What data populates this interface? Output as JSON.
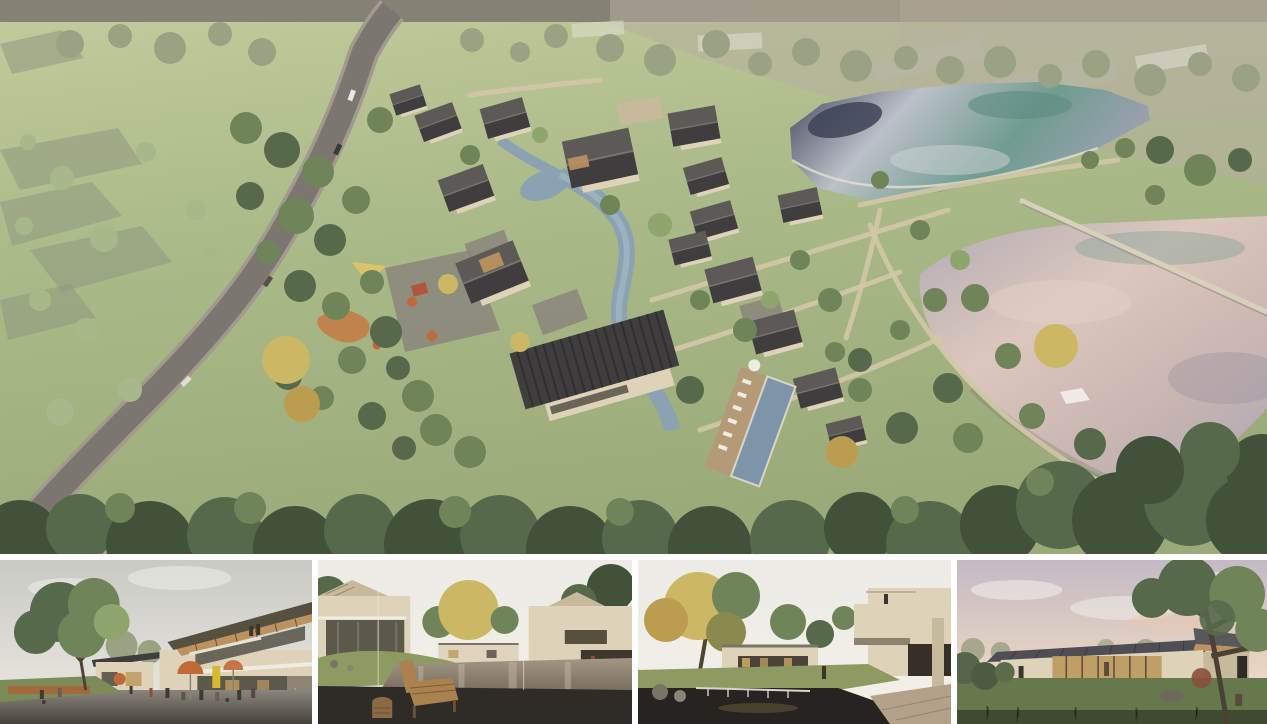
{
  "board": {
    "kind": "architectural rendering presentation board",
    "main_panel": {
      "name": "aerial-site-render",
      "description": "Aerial rendering of a courtyard-house resort village with dark gable roofs along a winding stream, an access road on the left, two large ponds on the right and dense tree canopy in the foreground"
    },
    "thumbnails": [
      {
        "name": "plaza-cafe-view",
        "description": "Street-level plaza with cafe umbrellas and people below a two-storey building with a slanted timber roof"
      },
      {
        "name": "courtyard-pool-view",
        "description": "Reflecting-pool courtyard between beige houses with a wooden lounge chair on a dark deck in the foreground"
      },
      {
        "name": "garden-pond-view",
        "description": "Garden court with a waterfall pond, autumn tree and cantilevered beige guest-room volumes"
      },
      {
        "name": "pavilion-dusk-view",
        "description": "Single-storey glass pavilion with a dark standing-seam roof on a lawn under a pink dusk sky"
      }
    ]
  },
  "palette": {
    "field1": "#b6af9f",
    "field2": "#c3cb9d",
    "field3": "#aaba88",
    "field4": "#9aab79",
    "roadDark": "#7b766f",
    "roadLight": "#a29a8e",
    "pathTan": "#d3c6a7",
    "canopyDark": "#41513a",
    "canopyMid": "#57694b",
    "treeMid": "#6f8458",
    "treeLight": "#8ea56e",
    "treePale": "#a9b88a",
    "treeHazy": "#99a384",
    "gold": "#ccb765",
    "goldDeep": "#bc9c4e",
    "roofDark": "#3f3d3e",
    "roofLight": "#5d5957",
    "roofRidge": "#787570",
    "wall": "#ded3b9",
    "wallShade": "#c6b99c",
    "wood": "#bb9260",
    "streamBlue": "#8ba2b2",
    "streamLight": "#aabfca",
    "poolBlue": "#7e95a9",
    "deckTan": "#b49a76",
    "pondNavy": "#3e4257",
    "pondSilver": "#bcc0c8",
    "pondTeal": "#6f9c90",
    "pondGrayBlue": "#9aa1ae",
    "pondMauve": "#b0abb5",
    "pondPink": "#c9b5b1",
    "pondPinkLight": "#dcc7bd",
    "weir": "#d7d0bb",
    "ghost": "#e9e6dd",
    "ghostGray": "#b9b5aa",
    "plotGray": "#8f977f",
    "orange": "#c2693a",
    "redRoof": "#b0563a",
    "sailYellow": "#dac36b",
    "playOrange": "#c8773f",
    "signYellow": "#d8b832",
    "paving": "#8b867d",
    "pavingDark": "#474239",
    "deckDark": "#2f2b26",
    "benchWood": "#a9824f",
    "stoolWood": "#8a6a45",
    "glassDark": "#4e4a3e",
    "glassWarm": "#bd9a5e",
    "glassCool": "#8c8f86",
    "stone": "#b3a289",
    "grassT": "#7d8b58",
    "grassT2": "#8d9b62",
    "sky1a": "#c9c9c5",
    "sky1b": "#eceae2",
    "sky2a": "#ecebe5",
    "sky2b": "#f3f0e9",
    "sky4a": "#c3bac4",
    "sky4b": "#ead6c2",
    "cloudPink": "#e8c9b4",
    "white": "#f2f1ec",
    "darkFig": "#3a352d",
    "trunk": "#4f4336",
    "waterT2a": "#a39684",
    "waterT2b": "#6f6557",
    "pondFg": "#262320",
    "lawn4": "#66794c",
    "lawn4d": "#3f4a30",
    "shrubRed": "#8a4f3a"
  }
}
